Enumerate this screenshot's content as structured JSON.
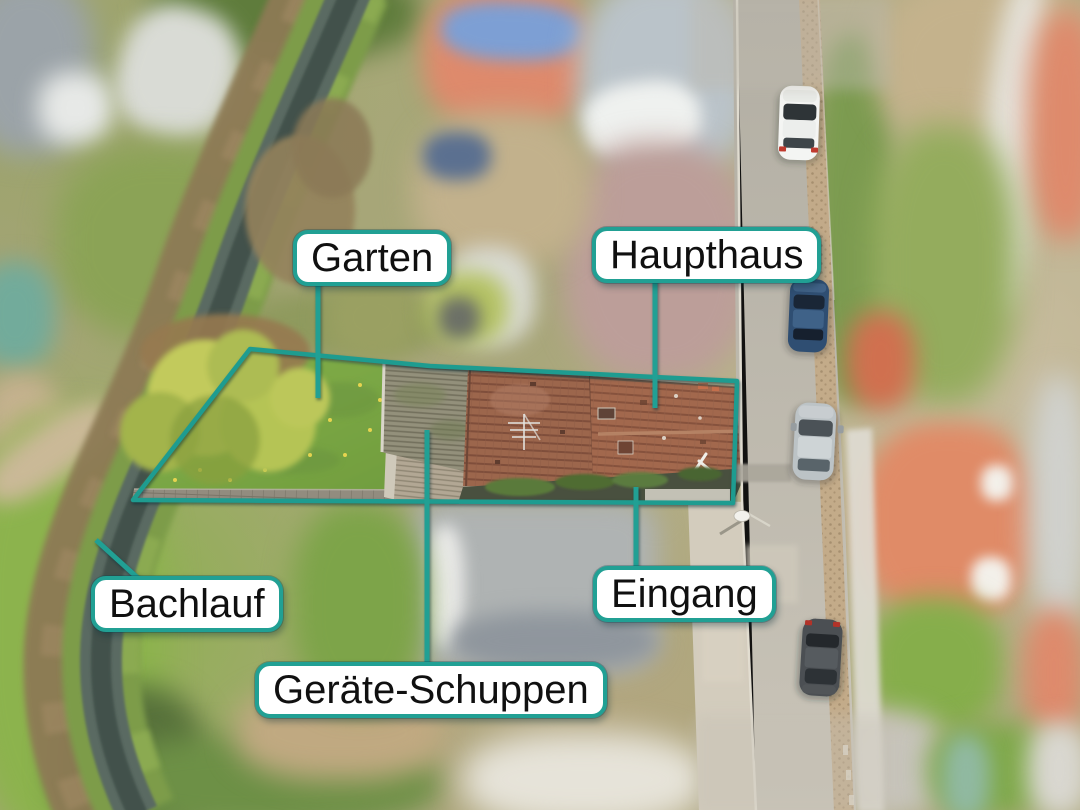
{
  "annotations": {
    "labels": {
      "garten": "Garten",
      "haupthaus": "Haupthaus",
      "bachlauf": "Bachlauf",
      "eingang": "Eingang",
      "geraete_schuppen": "Geräte-Schuppen"
    },
    "colors": {
      "annotation_line": "#21a094",
      "label_background": "#ffffff",
      "label_border": "#21a094",
      "label_text": "#101010"
    }
  }
}
